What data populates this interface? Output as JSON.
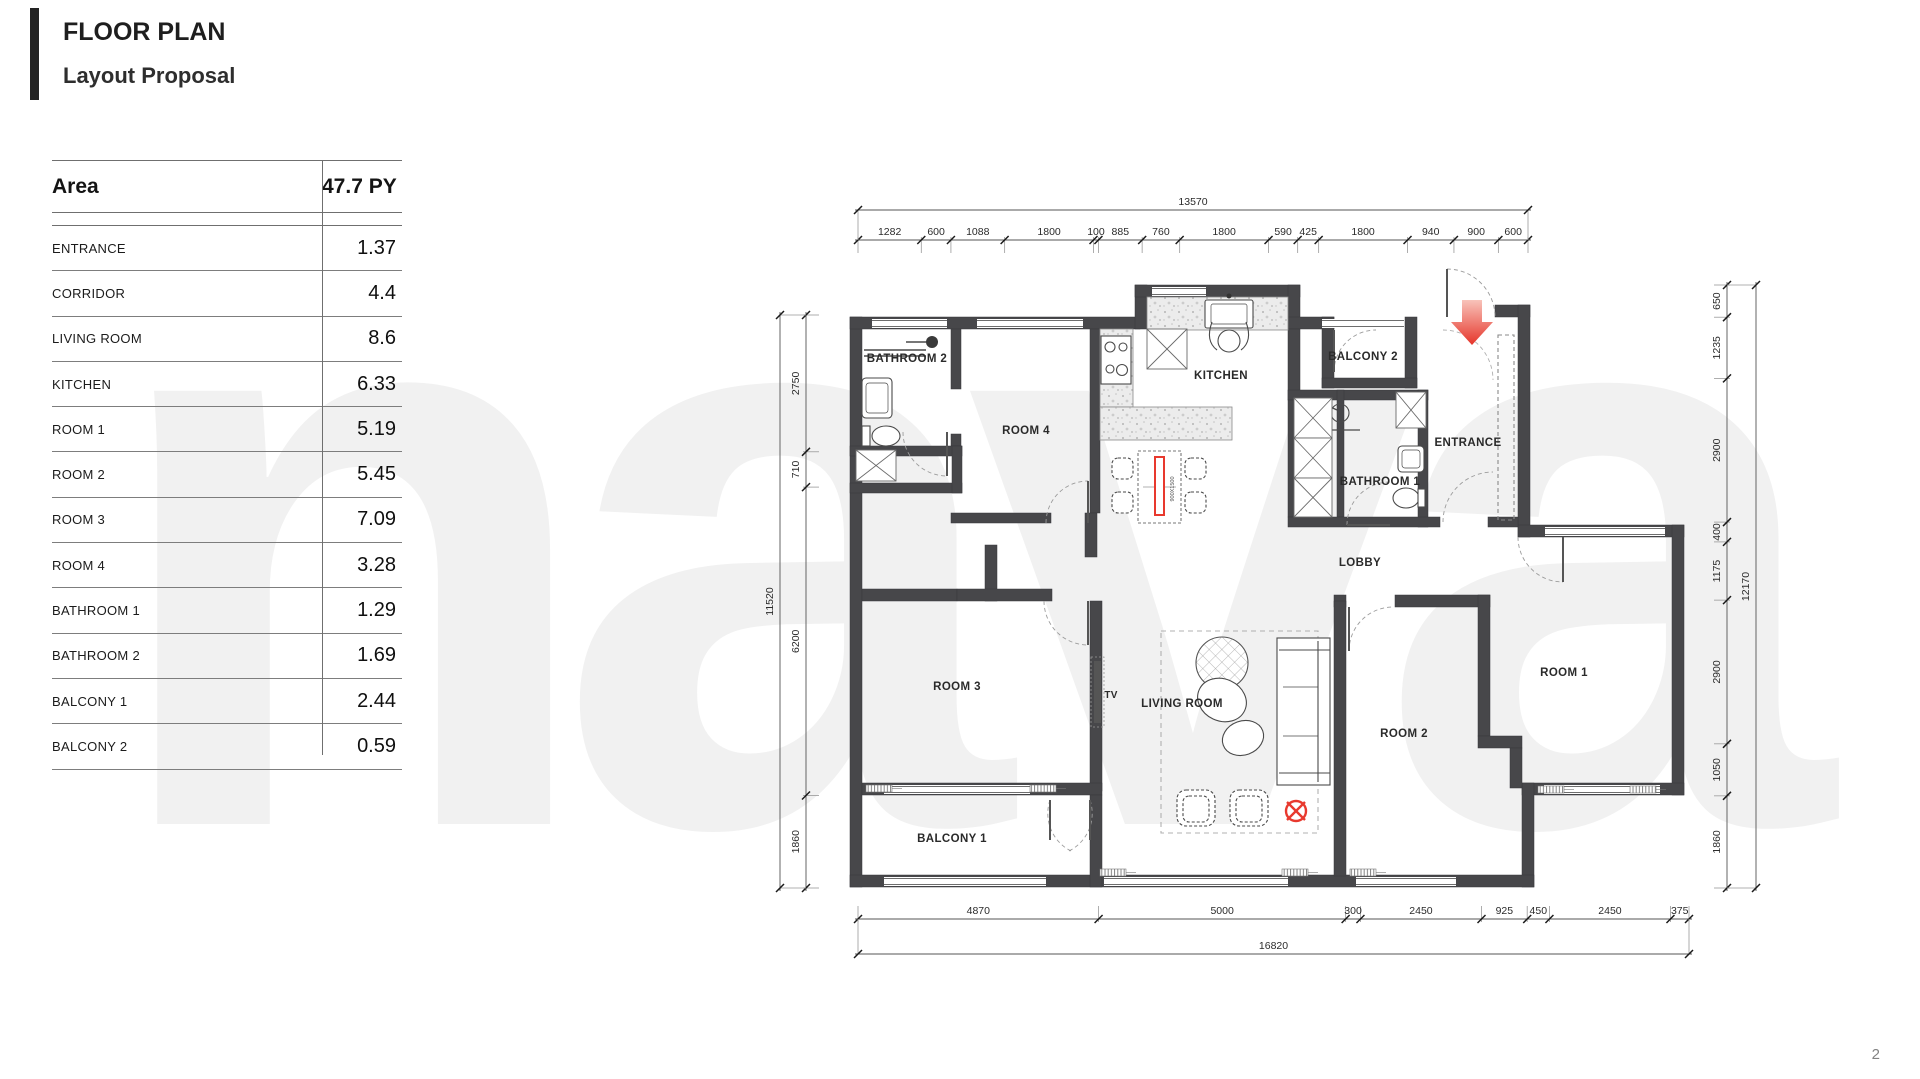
{
  "header": {
    "title": "FLOOR PLAN",
    "subtitle": "Layout Proposal"
  },
  "watermark": "nava",
  "page_number": "2",
  "area_table": {
    "col_label": "Area",
    "col_value": "47.7 PY",
    "rows": [
      {
        "label": "ENTRANCE",
        "value": "1.37"
      },
      {
        "label": "CORRIDOR",
        "value": "4.4"
      },
      {
        "label": "LIVING ROOM",
        "value": "8.6"
      },
      {
        "label": "KITCHEN",
        "value": "6.33"
      },
      {
        "label": "ROOM 1",
        "value": "5.19"
      },
      {
        "label": "ROOM 2",
        "value": "5.45"
      },
      {
        "label": "ROOM 3",
        "value": "7.09"
      },
      {
        "label": "ROOM 4",
        "value": "3.28"
      },
      {
        "label": "BATHROOM 1",
        "value": "1.29"
      },
      {
        "label": "BATHROOM 2",
        "value": "1.69"
      },
      {
        "label": "BALCONY 1",
        "value": "2.44"
      },
      {
        "label": "BALCONY 2",
        "value": "0.59"
      }
    ]
  },
  "floorplan": {
    "room_labels": [
      {
        "id": "bathroom-2",
        "text": "BATHROOM 2",
        "x": 907,
        "y": 362
      },
      {
        "id": "room-4",
        "text": "ROOM 4",
        "x": 1026,
        "y": 434
      },
      {
        "id": "kitchen",
        "text": "KITCHEN",
        "x": 1221,
        "y": 379
      },
      {
        "id": "balcony-2",
        "text": "BALCONY 2",
        "x": 1363,
        "y": 360
      },
      {
        "id": "entrance",
        "text": "ENTRANCE",
        "x": 1468,
        "y": 446
      },
      {
        "id": "bathroom-1",
        "text": "BATHROOM 1",
        "x": 1380,
        "y": 485
      },
      {
        "id": "lobby",
        "text": "LOBBY",
        "x": 1360,
        "y": 566
      },
      {
        "id": "room-3",
        "text": "ROOM 3",
        "x": 957,
        "y": 690
      },
      {
        "id": "living-room",
        "text": "LIVING ROOM",
        "x": 1182,
        "y": 707
      },
      {
        "id": "room-1",
        "text": "ROOM 1",
        "x": 1564,
        "y": 676
      },
      {
        "id": "room-2",
        "text": "ROOM 2",
        "x": 1404,
        "y": 737
      },
      {
        "id": "balcony-1",
        "text": "BALCONY 1",
        "x": 952,
        "y": 842
      },
      {
        "id": "tv",
        "text": "TV",
        "x": 1111,
        "y": 698
      }
    ],
    "furniture_note": "900X1500",
    "dimensions": {
      "top": {
        "total": "13570",
        "segments": [
          "1282",
          "600",
          "1088",
          "1800",
          "100",
          "885",
          "760",
          "1800",
          "590",
          "425",
          "1800",
          "940",
          "900",
          "600"
        ]
      },
      "bottom": {
        "total": "16820",
        "segments": [
          "4870",
          "5000",
          "300",
          "2450",
          "925",
          "450",
          "2450",
          "375"
        ]
      },
      "left": {
        "total": "11520",
        "segments": [
          "2750",
          "710",
          "6200",
          "1860"
        ]
      },
      "right": {
        "total": "12170",
        "segments": [
          "650",
          "1235",
          "2900",
          "400",
          "1175",
          "2900",
          "1050",
          "1860"
        ]
      }
    }
  }
}
